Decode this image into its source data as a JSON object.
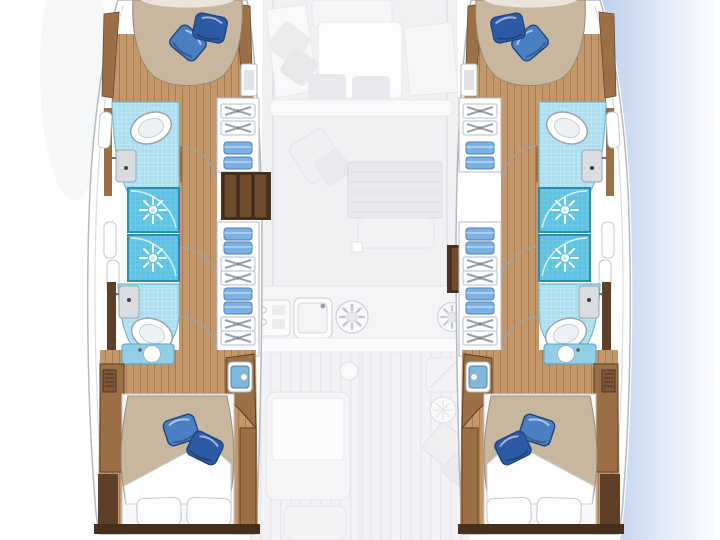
{
  "colors": {
    "background": "#ffffff",
    "water_edge": "#bdd0ee",
    "hull_outline": "#b4b9c0",
    "hull_fill": "#ffffff",
    "wood": "#9c7047",
    "wood_dark": "#5e3f28",
    "wood_floor": "#c39769",
    "steps": "#4a3220",
    "step_plank": "#6e4b2c",
    "bed_duvet": "#c8b79f",
    "pillow_light": "#4a7fc2",
    "pillow_dark": "#2c5aa4",
    "pillow_edge": "#20457f",
    "shower_tile": "#5ec3e1",
    "shower_border": "#2b8fb4",
    "bath_floor": "#abdff0",
    "bath_border": "#74b7cf",
    "sink_gray": "#d9dde1",
    "fixture_outline": "#9aa3ab",
    "towel": "#7cb1e2",
    "towel_edge": "#4a7fb5",
    "vanity_counter": "#92cfe7",
    "transom": "#452f1d",
    "faded_fill": "#f1f1f4",
    "faded_edge": "#e3e3e8"
  },
  "icons": {
    "shower_head_icon": "white starburst on blue tile",
    "cooktop_burner_icon": "spoked circle",
    "toilet_icon": "oval bowl with inner ring",
    "door_swing_icon": "quarter-circle arc",
    "utensil_drawer_icon": "crossed gray utensils in drawer",
    "towel_shelf_icon": "folded blue towel"
  },
  "plan": {
    "style": "top-down yacht layout; lower-deck hulls in full color, main deck faded",
    "port_hull": {
      "forward_cabin": {
        "berth": "bow-shaped double",
        "pillows": [
          "blue",
          "blue"
        ]
      },
      "forward_bathroom": {
        "fixtures": [
          "toilet",
          "washbasin"
        ],
        "floor": "light blue tile"
      },
      "shower_stalls": 2,
      "aft_bathroom": {
        "fixtures": [
          "toilet",
          "washbasin"
        ],
        "floor": "light blue tile"
      },
      "companionway_steps": "dark wood, 3 treads, set forward",
      "storage": [
        "utensil drawers",
        "folded towel shelves"
      ],
      "aft_cabin": {
        "berth": "double with turned-down white sheet",
        "pillows": [
          "blue",
          "blue",
          "white",
          "white"
        ],
        "vanity": "round basin on blue counter",
        "wardrobe": "louvered wood locker"
      }
    },
    "starboard_hull": "mirror image of port hull; companionway steps set further aft",
    "main_deck_faded": {
      "bow_lounge": [
        "sun pads",
        "low table",
        "diamond cushions",
        "ottomans"
      ],
      "salon": [
        "striped dining table",
        "bench seat",
        "corner cushions"
      ],
      "galley": [
        "appliance unit",
        "double sink",
        "two cooktop burners"
      ],
      "aft_cockpit": [
        "sliding door band",
        "teak plank deck",
        "cockpit table",
        "seat",
        "wheel circle",
        "diamond cushions"
      ]
    },
    "totals": {
      "cabins": 4,
      "shower_stalls": 4,
      "toilets": 4,
      "double_berths": 4
    }
  }
}
